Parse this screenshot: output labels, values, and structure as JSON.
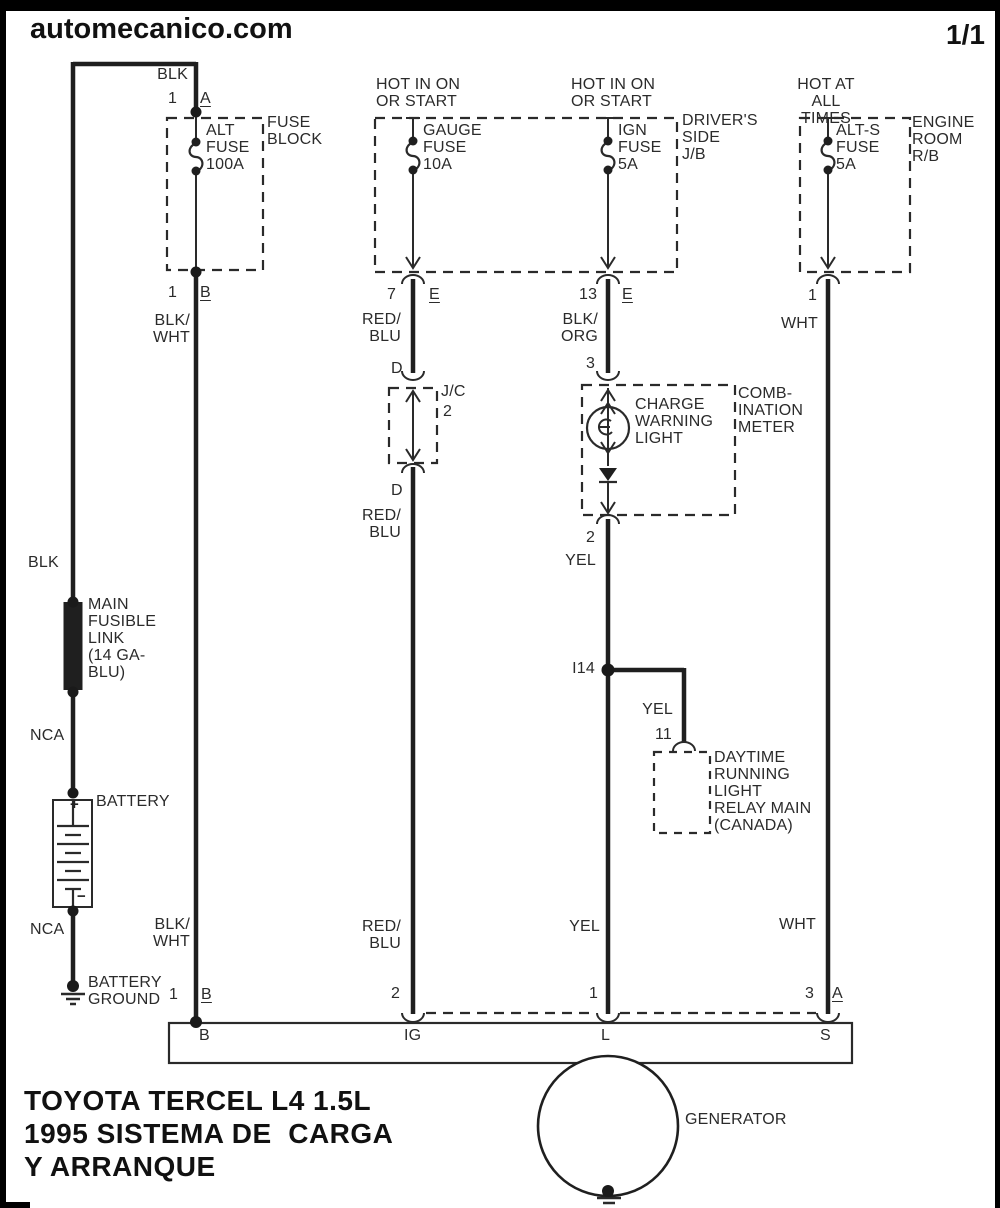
{
  "header": {
    "site": "automecanico.com",
    "page": "1/1"
  },
  "title": [
    "TOYOTA TERCEL L4 1.5L",
    "1995 SISTEMA DE  CARGA",
    "Y ARRANQUE"
  ],
  "colors": {
    "ink": "#1f1f1f",
    "background": "#ffffff"
  },
  "battery_circuit": {
    "wire_top": "BLK",
    "fusible_link": "MAIN\nFUSIBLE\nLINK\n(14 GA-\nBLU)",
    "nca_upper": "NCA",
    "battery_label": "BATTERY",
    "plus": "+",
    "minus": "−",
    "nca_lower": "NCA",
    "ground_label": "BATTERY\nGROUND"
  },
  "fuse_block": {
    "wire_in": "BLK",
    "pin_in_num": "1",
    "pin_in": "A",
    "box_label": "FUSE\nBLOCK",
    "fuse_label": "ALT\nFUSE\n100A",
    "pin_out_num": "1",
    "pin_out": "B",
    "wire_out": "BLK/\nWHT",
    "wire_bottom": "BLK/\nWHT",
    "gen_pin_num": "1",
    "gen_pin": "B"
  },
  "gauge_circuit": {
    "source": "HOT IN ON\nOR START",
    "fuse_label": "GAUGE\nFUSE\n10A",
    "pin_num": "7",
    "pin": "E",
    "wire1": "RED/\nBLU",
    "jc_pin_in": "D",
    "jc_label": "J/C",
    "jc_num": "2",
    "jc_pin_out": "D",
    "wire2": "RED/\nBLU",
    "wire_bottom": "RED/\nBLU",
    "gen_pin_num": "2"
  },
  "ign_circuit": {
    "source": "HOT IN ON\nOR START",
    "fuse_label": "IGN\nFUSE\n5A",
    "jb_label": "DRIVER'S\nSIDE\nJ/B",
    "pin_num": "13",
    "pin": "E",
    "wire1": "BLK/\nORG",
    "meter_pin_in": "3",
    "bulb_label": "CHARGE\nWARNING\nLIGHT",
    "meter_label": "COMB-\nINATION\nMETER",
    "meter_pin_out": "2",
    "wire2": "YEL",
    "junction": "I14",
    "branch_wire": "YEL",
    "branch_pin": "11",
    "relay_label": "DAYTIME\nRUNNING\nLIGHT\nRELAY MAIN\n(CANADA)",
    "wire_bottom": "YEL",
    "gen_pin_num": "1"
  },
  "alts_circuit": {
    "source": "HOT AT\nALL TIMES",
    "fuse_label": "ALT-S\nFUSE\n5A",
    "rb_label": "ENGINE\nROOM\nR/B",
    "pin_num": "1",
    "wire1": "WHT",
    "wire_bottom": "WHT",
    "gen_pin_num": "3",
    "gen_pin": "A"
  },
  "generator": {
    "label": "GENERATOR",
    "terminal_b": "B",
    "terminal_ig": "IG",
    "terminal_l": "L",
    "terminal_s": "S"
  }
}
